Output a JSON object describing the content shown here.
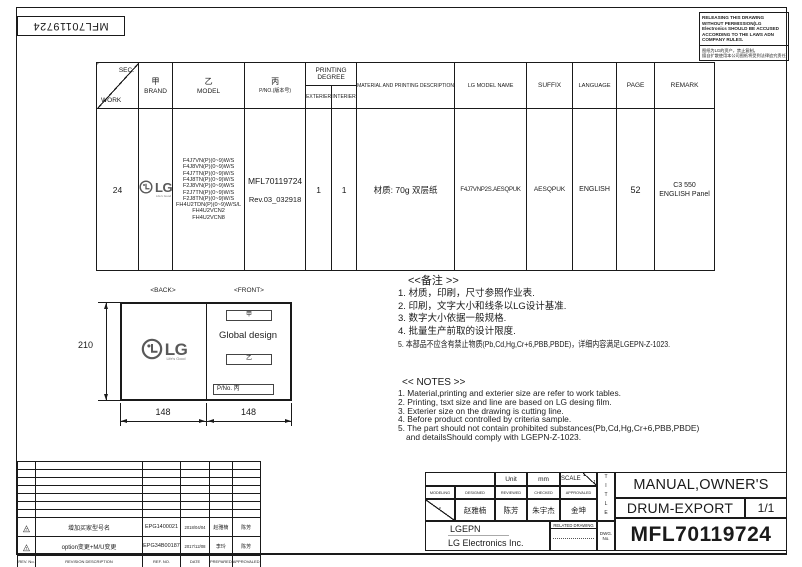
{
  "colors": {
    "line": "#1a1a1a",
    "logo_gray": "#595959"
  },
  "sheet": {
    "doc_no_top": "MFL70119724",
    "notice": {
      "en": "RELEASING THIS DRAWING WITHOUT PERMISSION(LG Electronics SHOULD BE ACCUSED ACCORDING TO THE LAWS ADN COMPANY RULES.",
      "cn_line1": "图纸为LG的资产，禁止复制。",
      "cn_line2": "擅自扩散使用本公司图纸将受到法律追究责任"
    }
  },
  "work_table": {
    "header": {
      "sec": "SEC.",
      "work": "WORK",
      "brand_cn": "甲",
      "brand": "BRAND",
      "model_cn": "乙",
      "model": "MODEL",
      "pno_cn": "丙",
      "pno": "P/NO.(版本号)",
      "printing_degree": "PRINTING DEGREE",
      "exterier": "EXTERIER",
      "interier": "INTERIER",
      "material": "MATERIAL AND PRINTING DESCRIPTION",
      "lg_model_name": "LG MODEL NAME",
      "suffix": "SUFFIX",
      "language": "LANGUAGE",
      "page": "PAGE",
      "remark": "REMARK"
    },
    "row": {
      "work": "24",
      "brand_logo": "LG",
      "brand_tagline": "Life's Good",
      "models": [
        "F4J7VN(P)(0~9)W/S",
        "F4J8VN(P)(0~9)W/S",
        "F4J7TN(P)(0~9)W/S",
        "F4J8TN(P)(0~9)W/S",
        "F2J8VN(P)(0~9)W/S",
        "F2J7TN(P)(0~9)W/S",
        "F2J8TN(P)(0~9)W/S",
        "FH4U2TDN(P)(0~9)W/S/L",
        "FH4U2VCN2",
        "FH4U2VCN8"
      ],
      "pno": "MFL70119724",
      "rev": "Rev.03_032918",
      "exterier": "1",
      "interier": "1",
      "material": "材质: 70g 双层纸",
      "lg_model_name": "F4J7VNP2S.AESQPUK",
      "suffix": "AESQPUK",
      "language": "ENGLISH",
      "page": "52",
      "remark_line1": "C3 550",
      "remark_line2": "ENGLISH Panel"
    }
  },
  "layout_diagram": {
    "back_label": "<BACK>",
    "front_label": "<FRONT>",
    "height_dim": "210",
    "width_left_dim": "148",
    "width_right_dim": "148",
    "logo_text": "LG",
    "logo_tagline": "Life's Good",
    "front_box_top": "甲",
    "front_center_text": "Global design",
    "front_box_mid": "乙",
    "front_box_bottom": "P/No.  丙"
  },
  "notes_cn": {
    "title": "<<备注 >>",
    "items": [
      "1.  材质，印刷，尺寸参照作业表.",
      "2.  印刷，文字大小和线条以LG设计基准.",
      "3.  数字大小依据一般规格.",
      "4.  批量生产前取的设计限度.",
      "5.  本部品不应含有禁止物质(Pb,Cd,Hg,Cr+6,PBB,PBDE)，详细内容满足LGEPN-Z-1023."
    ]
  },
  "notes_en": {
    "title": "<< NOTES >>",
    "items": [
      "1. Material,printing and exterier size are refer to work tables.",
      "2. Printing, tsxt  size and line are based on LG desing film.",
      "3. Exterier size on the drawing is cutting line.",
      "4. Before product controlled by criteria sample.",
      "5. The part should not contain prohibited substances(Pb,Cd,Hg,Cr+6,PBB,PBDE)",
      "and detailsShould comply with LGEPN-Z-1023."
    ]
  },
  "revision_table": {
    "rows": [
      {
        "mark": "2",
        "desc": "增加买家型号名",
        "ref_no": "EPG1400021",
        "date": "2018/04/04",
        "prepared": "赵雅楠",
        "approved": "陈芳"
      },
      {
        "mark": "1",
        "desc": "option变更+M/U变更",
        "ref_no": "EPG34B00187",
        "date": "2017/12/08",
        "prepared": "李玲",
        "approved": "陈芳"
      }
    ],
    "headers": {
      "rev_no": "REV. No.",
      "desc": "REVISION DESCRIPTION",
      "ref_no": "REF. NO.",
      "date": "DATE",
      "prepared": "PREPARED",
      "approved": "APPROVALED"
    }
  },
  "title_block": {
    "unit_label": "Unit",
    "unit_value": "mm",
    "scale_label": "SCALE",
    "scale_num": "1",
    "scale_den": "1",
    "cols": {
      "modeling": "MODELING",
      "designed": "DESIGNED",
      "reviewed": "REVIEWED",
      "checked": "CHECKED",
      "approvaled": "APPROVALED"
    },
    "names": {
      "designed": "赵雅楠",
      "reviewed": "陈芳",
      "checked": "朱宇杰",
      "approvaled": "金坤"
    },
    "company_short": "LGEPN",
    "company_full": "LG Electronics Inc.",
    "related_drawing": "RELATED DRAWING",
    "title_vertical": "TITLE",
    "dwg_label_1": "DWG.",
    "dwg_label_2": "No.",
    "title_line1": "MANUAL,OWNER'S",
    "title_line2": "DRUM-EXPORT",
    "sheet_no": "1/1",
    "dwg_no": "MFL70119724"
  }
}
